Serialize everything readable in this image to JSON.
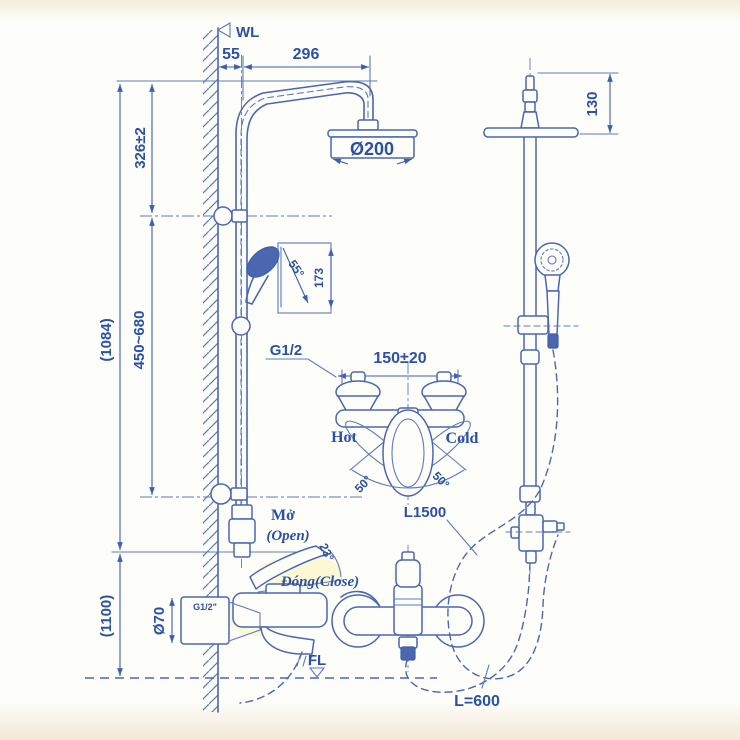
{
  "title": "Shower column installation drawing",
  "colors": {
    "line": "#4a67b0",
    "text": "#2b50a6",
    "highlight": "#f3ea6e",
    "background": "#fdfdfa"
  },
  "front_view": {
    "wall_label": "WL",
    "floor_label": "FL",
    "dims": {
      "wall_offset": "55",
      "arm_reach": "296",
      "head_to_bracket": "326±2",
      "column_height": "(1084)",
      "slider_range": "450~680",
      "mixer_height": "(1100)",
      "head_diameter": "Ø200",
      "handshower_length": "173",
      "handshower_angle": "55°",
      "flange_diameter": "Ø70",
      "inlet_thread": "G1/2\""
    },
    "mixer": {
      "open_vi": "Mở",
      "open_en": "(Open)",
      "open_angle": "23°",
      "close_label": "Đóng(Close)"
    }
  },
  "valve_detail": {
    "thread": "G1/2",
    "center_distance": "150±20",
    "hot": "Hot",
    "cold": "Cold",
    "swing_left": "50°",
    "swing_right": "50°"
  },
  "side_view": {
    "head_height": "130",
    "handshower_hose": "L1500",
    "supply_hose": "L=600"
  }
}
